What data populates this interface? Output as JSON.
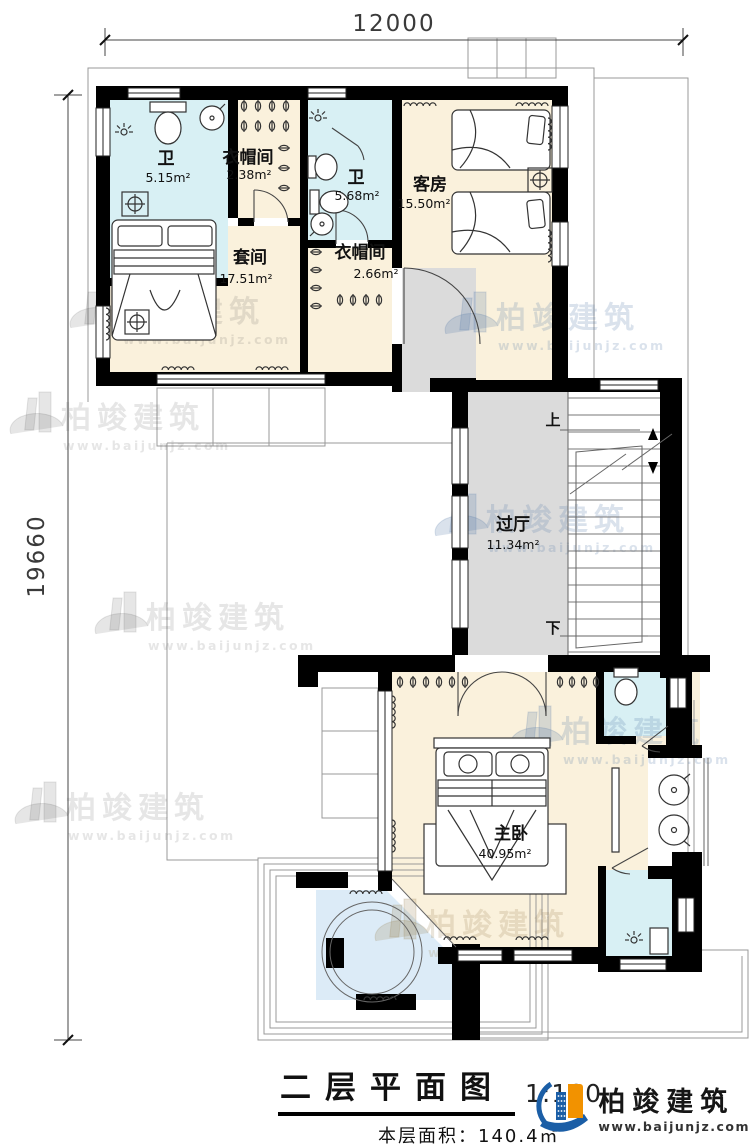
{
  "dims": {
    "top": "12000",
    "left": "19660"
  },
  "rooms": {
    "bath1": {
      "name": "卫",
      "area": "5.15m²"
    },
    "cloak1": {
      "name": "衣帽间",
      "area": "2.38m²"
    },
    "bath2": {
      "name": "卫",
      "area": "5.68m²"
    },
    "guest": {
      "name": "客房",
      "area": "15.50m²"
    },
    "suite": {
      "name": "套间",
      "area": "17.51m²"
    },
    "cloak2": {
      "name": "衣帽间",
      "area": "2.66m²"
    },
    "hall": {
      "name": "过厅",
      "area": "11.34m²"
    },
    "master": {
      "name": "主卧",
      "area": "40.95m²"
    }
  },
  "stairs": {
    "up": "上",
    "down": "下"
  },
  "watermark": {
    "brand": "柏竣建筑",
    "url": "www.baijunjz.com"
  },
  "titleblock": {
    "title": "二层平面图",
    "scale": "1:100",
    "floor_area": "本层面积：140.4㎡"
  },
  "logo": {
    "brand": "柏竣建筑",
    "url": "www.baijunjz.com"
  },
  "colors": {
    "wall": "#000000",
    "room_cream": "#FAF1DC",
    "room_bath": "#D8F0F4",
    "hall_gray": "#DBDBDB",
    "terrace_blue": "#DCEBF7",
    "logo_blue": "#1B5EA6",
    "logo_orange": "#F29200"
  }
}
